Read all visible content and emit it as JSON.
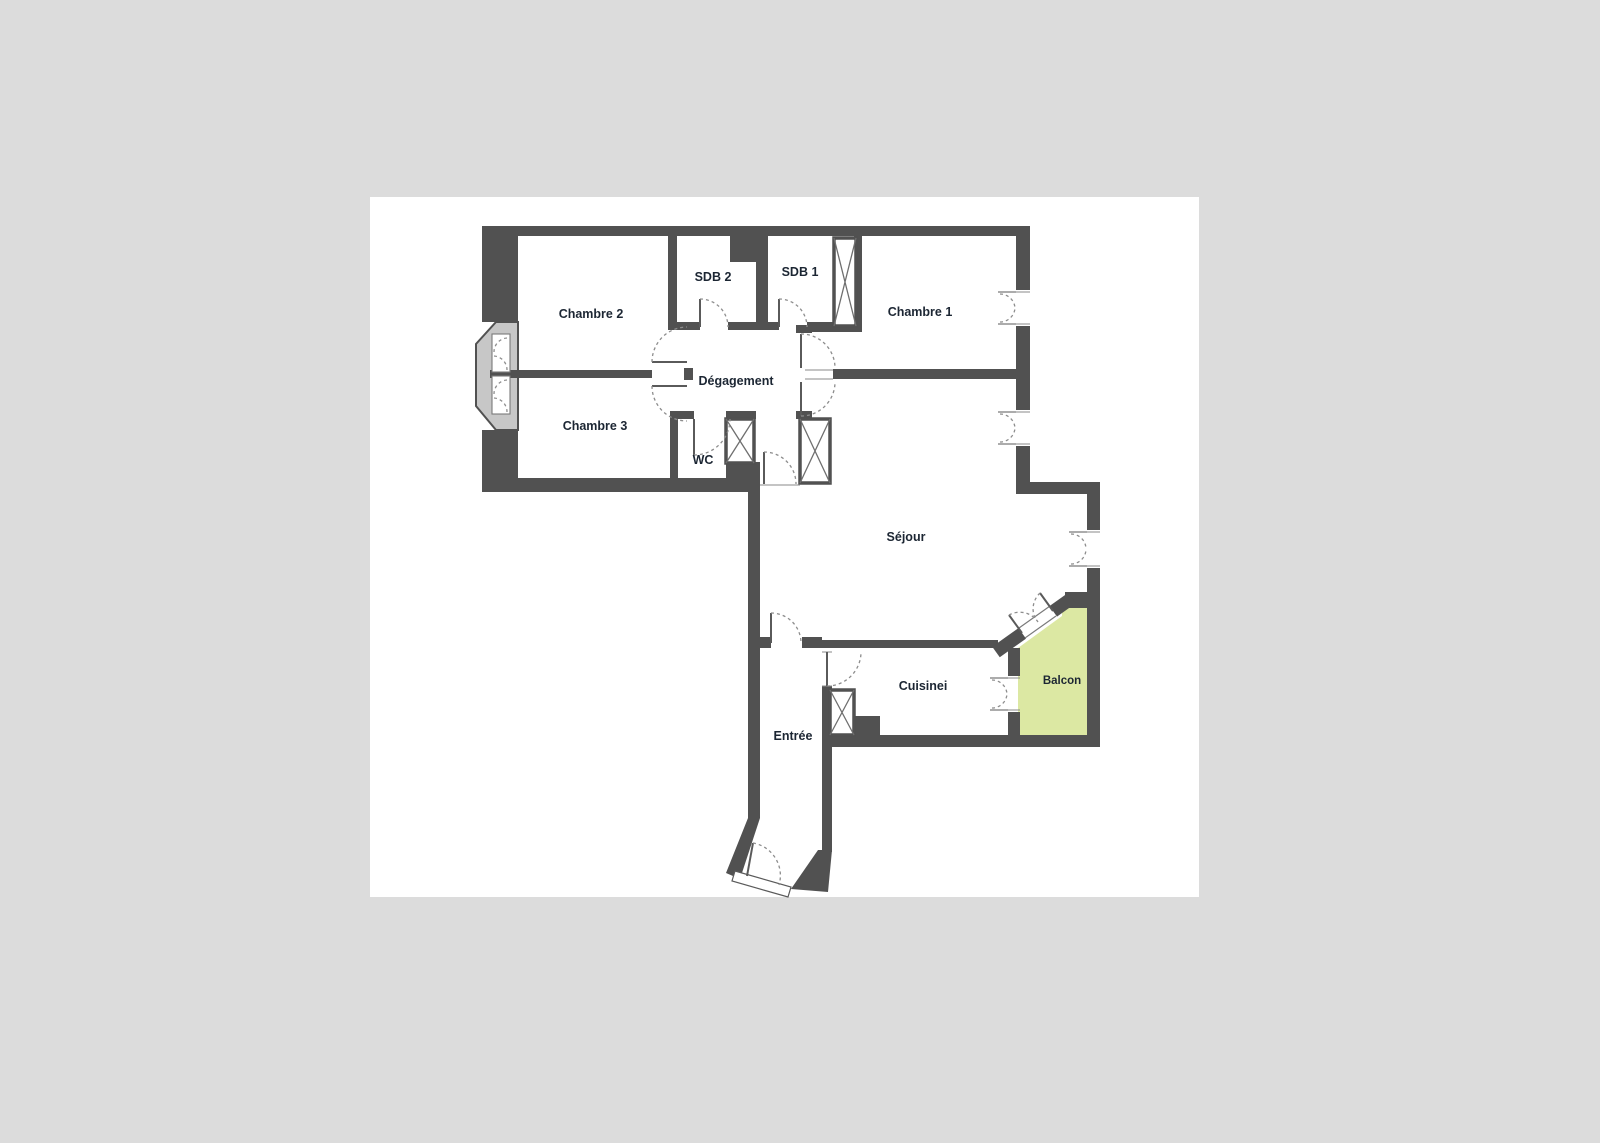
{
  "plan": {
    "rooms": {
      "chambre_2": "Chambre 2",
      "sdb_2": "SDB 2",
      "sdb_1": "SDB 1",
      "chambre_1": "Chambre 1",
      "degagement": "Dégagement",
      "chambre_3": "Chambre 3",
      "wc": "WC",
      "sejour": "Séjour",
      "cuisine": "Cuisinei",
      "entree": "Entrée",
      "balcon": "Balcon"
    },
    "colors": {
      "wall": "#515151",
      "balcony_fill": "#dce8a3",
      "bay_fill": "#c7c7c7",
      "page_background": "#dcdcdc",
      "page": "#ffffff",
      "label_text": "#1c2633"
    }
  }
}
